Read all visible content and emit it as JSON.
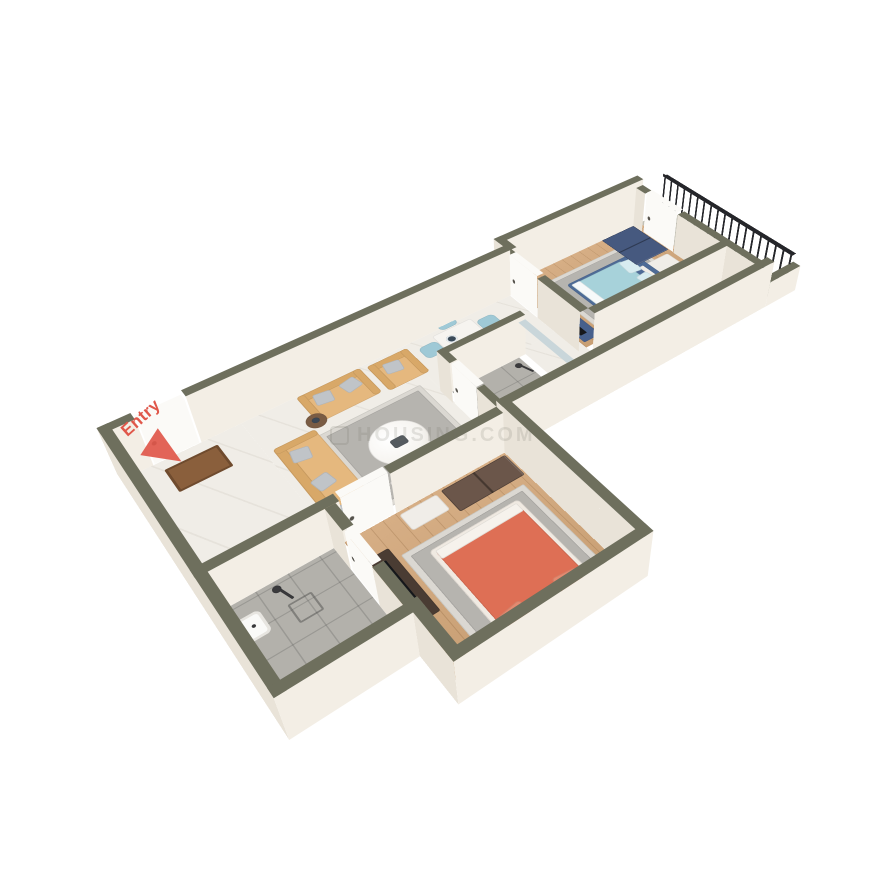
{
  "labels": {
    "entry": "Entry",
    "watermark": "HOUSING.COM"
  },
  "colors": {
    "background": "#ffffff",
    "wallTop": "#6e6f5d",
    "wallFace": "#f3eee5",
    "wallFaceShade": "#e9e3d8",
    "doorWhite": "#fbfaf7",
    "railDark": "#25262a",
    "glassTop": "#c9d6da",
    "glassFace": "#dfeaf0",
    "marble": "#f0ede7",
    "wood": "#d6ae85",
    "woodDeep": "#c89f74",
    "tile": "#b3b1ab",
    "concrete": "#c2c0b5",
    "rugOuter": "#dbd8d2",
    "rugInner": "#b6b4af",
    "sofaTan": "#e5b87e",
    "sofaTanDark": "#d8a868",
    "pillowGray": "#c0c4c8",
    "bedBlueFrame": "#4e6b96",
    "bedBlueDuvet": "#a7d2da",
    "bedBluePillow": "#d8ecf0",
    "bedOrangeDuvet": "#de6f55",
    "bedOrangePillow": "#e58a70",
    "bedWhiteFrame": "#f0eae2",
    "navyBench": "#3d5378",
    "wardrobeBlue": "#46597f",
    "wardrobeBrown": "#6b564a",
    "consoleDark": "#4a3c33",
    "consoleBlue": "#47608c",
    "dresserWhite": "#f0ede8",
    "chairBlue": "#9fc9d6",
    "tableWhite": "#f6f4f0",
    "plateDark": "#3a4a58",
    "counterTop": "#eef1f3",
    "kitchenBlue": "#bcd9e8",
    "stoveDark": "#26282c",
    "fridgeWhite": "#f1f1ee",
    "fixtureWhite": "#fafaf8",
    "chromeDark": "#3a3a3c",
    "matBrown": "#8a5f3c",
    "plantGreen": "#527d55",
    "plantDeep": "#3f6343",
    "potBrown": "#8a6a52",
    "entryRed": "#e0574a",
    "watermarkGray": "#6f6f68"
  },
  "scene": {
    "perspective": 1000,
    "rotateX": 45,
    "rotateZ": -38,
    "scale": 0.88,
    "originX": 540,
    "originY": 420,
    "centerX": 410,
    "centerY": 250,
    "wallHeightOuter": 62,
    "wallHeightInner": 54,
    "doorHeight": 56,
    "railHeight": 46
  },
  "floors": [
    {
      "name": "hall-floor",
      "x": 12,
      "y": 46,
      "w": 128,
      "h": 208,
      "pattern": "marble"
    },
    {
      "name": "living-floor",
      "x": 140,
      "y": 46,
      "w": 210,
      "h": 208,
      "pattern": "marble"
    },
    {
      "name": "dining-floor",
      "x": 350,
      "y": 46,
      "w": 170,
      "h": 94,
      "pattern": "marble"
    },
    {
      "name": "kitchen-floor-nook",
      "x": 466,
      "y": 140,
      "w": 66,
      "h": 114,
      "pattern": "marble"
    },
    {
      "name": "kitchen-floor",
      "x": 532,
      "y": 198,
      "w": 232,
      "h": 56,
      "pattern": "marble"
    },
    {
      "name": "bedroom1-floor",
      "x": 532,
      "y": 26,
      "w": 232,
      "h": 160,
      "pattern": "wood"
    },
    {
      "name": "balcony-floor",
      "x": 764,
      "y": 26,
      "w": 56,
      "h": 228,
      "pattern": "concrete"
    },
    {
      "name": "bathroom2-floor",
      "x": 358,
      "y": 150,
      "w": 98,
      "h": 104,
      "pattern": "tile"
    },
    {
      "name": "bedroom2-floor",
      "x": 146,
      "y": 266,
      "w": 202,
      "h": 208,
      "pattern": "wood"
    },
    {
      "name": "bathroom1-floor",
      "x": 12,
      "y": 266,
      "w": 122,
      "h": 146,
      "pattern": "tile"
    }
  ],
  "walls": [
    {
      "name": "wall-top-a",
      "x": 0,
      "y": 34,
      "w": 36,
      "h": 12,
      "z": 62
    },
    {
      "name": "wall-top-b",
      "x": 92,
      "y": 34,
      "w": 430,
      "h": 12,
      "z": 62
    },
    {
      "name": "wall-top-jog",
      "x": 520,
      "y": 14,
      "w": 12,
      "h": 32,
      "z": 62
    },
    {
      "name": "wall-top-bedroom1",
      "x": 520,
      "y": 14,
      "w": 244,
      "h": 12,
      "z": 62
    },
    {
      "name": "wall-left-outer",
      "x": 0,
      "y": 34,
      "w": 12,
      "h": 390,
      "z": 62
    },
    {
      "name": "wall-bath1-bottom",
      "x": 0,
      "y": 412,
      "w": 146,
      "h": 12,
      "z": 62
    },
    {
      "name": "wall-bath1-east-a",
      "x": 134,
      "y": 266,
      "w": 12,
      "h": 34,
      "z": 54
    },
    {
      "name": "wall-bath1-east-b",
      "x": 134,
      "y": 354,
      "w": 12,
      "h": 58,
      "z": 54
    },
    {
      "name": "wall-bedroom2-west",
      "x": 134,
      "y": 412,
      "w": 12,
      "h": 74,
      "z": 62
    },
    {
      "name": "wall-bedroom2-bottom",
      "x": 134,
      "y": 474,
      "w": 226,
      "h": 12,
      "z": 62
    },
    {
      "name": "wall-bedroom2-east",
      "x": 348,
      "y": 254,
      "w": 12,
      "h": 232,
      "z": 62
    },
    {
      "name": "wall-south-hall",
      "x": 0,
      "y": 254,
      "w": 150,
      "h": 12,
      "z": 54
    },
    {
      "name": "wall-south-living",
      "x": 208,
      "y": 254,
      "w": 140,
      "h": 12,
      "z": 54
    },
    {
      "name": "wall-south-kitchen",
      "x": 348,
      "y": 254,
      "w": 416,
      "h": 12,
      "z": 62
    },
    {
      "name": "wall-balcony-south",
      "x": 764,
      "y": 254,
      "w": 56,
      "h": 12,
      "z": 34
    },
    {
      "name": "wall-bedroom1-west-a",
      "x": 520,
      "y": 26,
      "w": 12,
      "h": 18,
      "z": 54
    },
    {
      "name": "wall-bedroom1-west-b",
      "x": 520,
      "y": 104,
      "w": 12,
      "h": 82,
      "z": 54
    },
    {
      "name": "wall-bedroom1-south",
      "x": 532,
      "y": 186,
      "w": 232,
      "h": 12,
      "z": 54
    },
    {
      "name": "wall-balcony-part-a",
      "x": 752,
      "y": 26,
      "w": 12,
      "h": 18,
      "z": 54
    },
    {
      "name": "wall-balcony-part-b",
      "x": 752,
      "y": 108,
      "w": 12,
      "h": 146,
      "z": 54
    },
    {
      "name": "wall-bath2-north",
      "x": 352,
      "y": 140,
      "w": 114,
      "h": 10,
      "z": 54
    },
    {
      "name": "wall-bath2-west-a",
      "x": 348,
      "y": 140,
      "w": 10,
      "h": 26,
      "z": 54
    },
    {
      "name": "wall-bath2-west-b",
      "x": 348,
      "y": 218,
      "w": 10,
      "h": 36,
      "z": 54
    },
    {
      "name": "wall-bath2-glass",
      "x": 456,
      "y": 150,
      "w": 10,
      "h": 104,
      "z": 48,
      "glass": true
    }
  ],
  "doors": [
    {
      "name": "entry-door",
      "x": 38,
      "y": 35,
      "w": 52,
      "h": 10,
      "z": 58
    },
    {
      "name": "bedroom1-door",
      "x": 521,
      "y": 46,
      "w": 10,
      "h": 56,
      "z": 56
    },
    {
      "name": "bathroom2-door",
      "x": 349,
      "y": 168,
      "w": 10,
      "h": 48,
      "z": 54
    },
    {
      "name": "bedroom2-door",
      "x": 152,
      "y": 255,
      "w": 54,
      "h": 10,
      "z": 56
    },
    {
      "name": "bathroom1-door",
      "x": 135,
      "y": 302,
      "w": 10,
      "h": 50,
      "z": 54
    },
    {
      "name": "balcony-door",
      "x": 753,
      "y": 46,
      "w": 10,
      "h": 60,
      "z": 56
    }
  ],
  "railings": [
    {
      "name": "balcony-railing",
      "x": 812,
      "y": 16,
      "w": 8,
      "h": 240,
      "z": 46
    }
  ],
  "furniture": [
    {
      "t": "rug",
      "name": "living-rug",
      "x": 198,
      "y": 118,
      "w": 136,
      "h": 138
    },
    {
      "t": "sofa",
      "name": "sofa-3-seater",
      "x": 148,
      "y": 108,
      "w": 52,
      "h": 140,
      "face": "e",
      "seats": 3
    },
    {
      "t": "sofa",
      "name": "sofa-2-seater",
      "x": 208,
      "y": 50,
      "w": 84,
      "h": 52,
      "face": "s",
      "seats": 2
    },
    {
      "t": "sofa",
      "name": "sofa-armchair",
      "x": 300,
      "y": 54,
      "w": 56,
      "h": 52,
      "face": "s",
      "seats": 1
    },
    {
      "t": "sidetable",
      "name": "side-table",
      "x": 196,
      "y": 86,
      "w": 24,
      "h": 24
    },
    {
      "t": "coffeetable",
      "name": "coffee-table",
      "x": 230,
      "y": 150,
      "w": 68,
      "h": 68
    },
    {
      "t": "sideboard",
      "name": "tv-sideboard",
      "x": 224,
      "y": 228,
      "w": 96,
      "h": 24
    },
    {
      "t": "dining",
      "name": "dining-set",
      "x": 392,
      "y": 56,
      "w": 58,
      "h": 88,
      "chairs": 5
    },
    {
      "t": "fridge",
      "name": "fridge",
      "x": 538,
      "y": 202,
      "w": 40,
      "h": 48
    },
    {
      "t": "counter",
      "name": "kitchen-counter",
      "x": 466,
      "y": 224,
      "w": 298,
      "h": 28
    },
    {
      "t": "stove",
      "name": "cooktop",
      "x": 580,
      "y": 228,
      "w": 58,
      "h": 22
    },
    {
      "t": "toilet",
      "name": "toilet-bath2",
      "x": 420,
      "y": 196,
      "w": 34,
      "h": 32,
      "face": "w"
    },
    {
      "t": "basin",
      "name": "basin-bath2",
      "x": 408,
      "y": 232,
      "w": 28,
      "h": 18
    },
    {
      "t": "shower",
      "name": "shower-bath2",
      "x": 440,
      "y": 160,
      "w": 20,
      "h": 20
    },
    {
      "t": "rug",
      "name": "bedroom1-rug",
      "x": 566,
      "y": 54,
      "w": 154,
      "h": 128
    },
    {
      "t": "bed",
      "name": "bed-bedroom1",
      "x": 590,
      "y": 76,
      "w": 112,
      "h": 82,
      "head": "e",
      "frame": "#4e6b96",
      "duvet": "#a7d2da",
      "pillow": "#d8ecf0"
    },
    {
      "t": "box",
      "name": "bed-bench",
      "x": 600,
      "y": 164,
      "w": 66,
      "h": 14,
      "fill": "#3d5378"
    },
    {
      "t": "nightstand",
      "name": "nightstand-bedroom1",
      "x": 706,
      "y": 158,
      "w": 24,
      "h": 22,
      "fill": "#46597f"
    },
    {
      "t": "wardrobe",
      "name": "wardrobe-blue",
      "x": 690,
      "y": 30,
      "w": 58,
      "h": 72,
      "fill": "#46597f",
      "dir": "y"
    },
    {
      "t": "box",
      "name": "dresser-bedroom1",
      "x": 690,
      "y": 106,
      "w": 52,
      "h": 32,
      "fill": "#f0ede8"
    },
    {
      "t": "tvconsole",
      "name": "tv-console-bedroom1",
      "x": 534,
      "y": 106,
      "w": 26,
      "h": 74,
      "fill": "#47608c",
      "dir": "y"
    },
    {
      "t": "rug",
      "name": "bedroom2-rug",
      "x": 182,
      "y": 316,
      "w": 154,
      "h": 150
    },
    {
      "t": "bed",
      "name": "bed-bedroom2",
      "x": 206,
      "y": 330,
      "w": 112,
      "h": 138,
      "head": "s",
      "frame": "#f0eae2",
      "duvet": "#de6f55",
      "pillow": "#e58a70"
    },
    {
      "t": "nightstand",
      "name": "nightstand-bedroom2",
      "x": 322,
      "y": 442,
      "w": 26,
      "h": 24,
      "fill": "#f4f1ec"
    },
    {
      "t": "wardrobe",
      "name": "wardrobe-brown",
      "x": 260,
      "y": 272,
      "w": 84,
      "h": 36,
      "fill": "#6b564a",
      "dir": "x"
    },
    {
      "t": "box",
      "name": "dresser-bedroom2",
      "x": 208,
      "y": 272,
      "w": 46,
      "h": 26,
      "fill": "#f0ede8"
    },
    {
      "t": "tvconsole",
      "name": "tv-console-bedroom2",
      "x": 152,
      "y": 302,
      "w": 24,
      "h": 94,
      "fill": "#4a3c33",
      "dir": "y"
    },
    {
      "t": "basin",
      "name": "basin-bath1",
      "x": 16,
      "y": 288,
      "w": 24,
      "h": 30
    },
    {
      "t": "shower",
      "name": "shower-bath1",
      "x": 60,
      "y": 274,
      "w": 20,
      "h": 20
    },
    {
      "t": "drain",
      "name": "shower-drain",
      "x": 64,
      "y": 300,
      "w": 26,
      "h": 26
    },
    {
      "t": "toilet",
      "name": "toilet-bath1",
      "x": 62,
      "y": 370,
      "w": 30,
      "h": 38,
      "face": "n"
    },
    {
      "t": "mat",
      "name": "entry-doormat",
      "x": 42,
      "y": 62,
      "w": 62,
      "h": 40
    },
    {
      "t": "plant",
      "name": "balcony-plant",
      "x": 788,
      "y": 212,
      "w": 30,
      "h": 30
    }
  ]
}
